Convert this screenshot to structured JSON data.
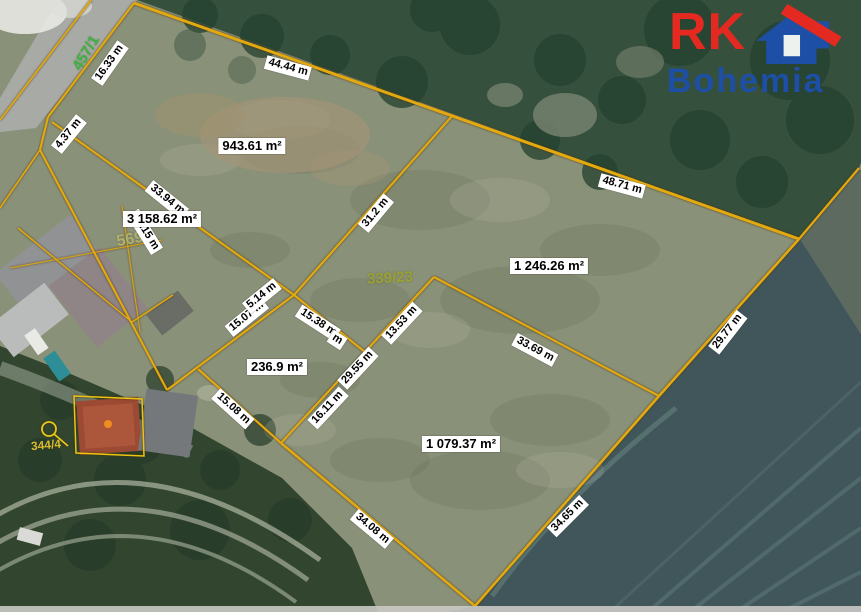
{
  "logo": {
    "rk": "RK",
    "bohemia": "Bohemia",
    "rk_color": "#e42a20",
    "bohemia_color": "#1d4fa6",
    "house_icon_blue": "#1d4fa6",
    "house_icon_red": "#e42a20"
  },
  "map": {
    "line_color": "#e3a90f",
    "parcel_area_labels": [
      {
        "text": "943.61 m²"
      },
      {
        "text": "3 158.62 m²"
      },
      {
        "text": "1 246.26 m²"
      },
      {
        "text": "236.9 m²"
      },
      {
        "text": "1 079.37 m²"
      }
    ],
    "dimension_labels": [
      {
        "text": "16.33 m"
      },
      {
        "text": "4.37 m"
      },
      {
        "text": "44.44 m"
      },
      {
        "text": "48.71 m"
      },
      {
        "text": "33.94 m"
      },
      {
        "text": "35.15 m"
      },
      {
        "text": "31.2 m"
      },
      {
        "text": "29.77 m"
      },
      {
        "text": "33.69 m"
      },
      {
        "text": "13.53 m"
      },
      {
        "text": "29.55 m"
      },
      {
        "text": "16.11 m"
      },
      {
        "text": "15.38 m"
      },
      {
        "text": "m"
      },
      {
        "text": "15.07 m"
      },
      {
        "text": "5.14 m"
      },
      {
        "text": "15.08 m"
      },
      {
        "text": "34.08 m"
      },
      {
        "text": "34.65 m"
      }
    ],
    "parcel_numbers": [
      {
        "text": "457/1",
        "color": "#3db33d"
      },
      {
        "text": "569",
        "color": "#b5b467"
      },
      {
        "text": "339/23",
        "color": "#9ca32f"
      },
      {
        "text": "344/4",
        "color": "#d9bd2e"
      }
    ]
  }
}
